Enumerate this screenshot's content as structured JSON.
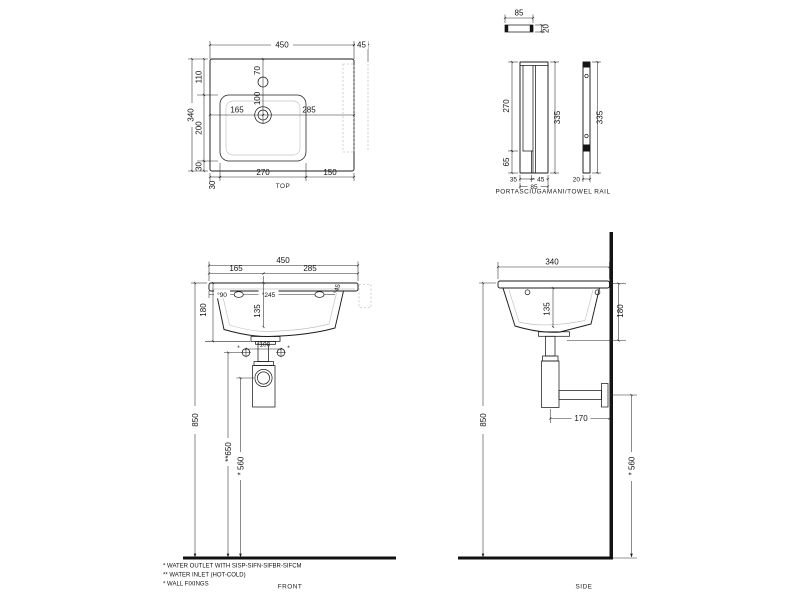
{
  "drawing": {
    "type": "washbasin technical drawing",
    "views": [
      "TOP",
      "PORTASCIUGAMANI/TOWEL RAIL",
      "FRONT",
      "SIDE"
    ]
  },
  "top": {
    "caption": "TOP",
    "w": "450",
    "shelf": "45",
    "h1": "110",
    "h2": "200",
    "h": "340",
    "h3": "30",
    "m_left": "30",
    "basin_w": "270",
    "m_right": "150",
    "faucet_y": "70",
    "drain_y": "100",
    "drain_l": "165",
    "drain_r": "285"
  },
  "rail": {
    "caption": "PORTASCIUGAMANI/TOWEL RAIL",
    "top_w": "85",
    "top_t": "20",
    "front_h1": "270",
    "front_h2": "65",
    "foot_w": "35",
    "bar_w": "45",
    "w": "85",
    "h": "335",
    "side_h": "335",
    "side_t": "20"
  },
  "front": {
    "caption": "FRONT",
    "w": "450",
    "tap_l": "165",
    "tap_r": "285",
    "hole1": "°90",
    "hole2": "°245",
    "hole3": "°45",
    "bowl_d": "135",
    "h": "180",
    "fix": "*100",
    "fix_mark": "*",
    "rim_h": "850",
    "inlet_h": "**650",
    "outlet_h": "* 560"
  },
  "side": {
    "caption": "SIDE",
    "d": "340",
    "bowl_d": "135",
    "h": "180",
    "trap": "170",
    "rim_h": "850",
    "outlet_h": "* 560"
  },
  "notes": {
    "outlet": "* WATER OUTLET WITH SISP-SIFN-SIFBR-SIFCM",
    "inlet": "** WATER INLET  (HOT-COLD)",
    "fixings": "* WALL FIXINGS"
  }
}
